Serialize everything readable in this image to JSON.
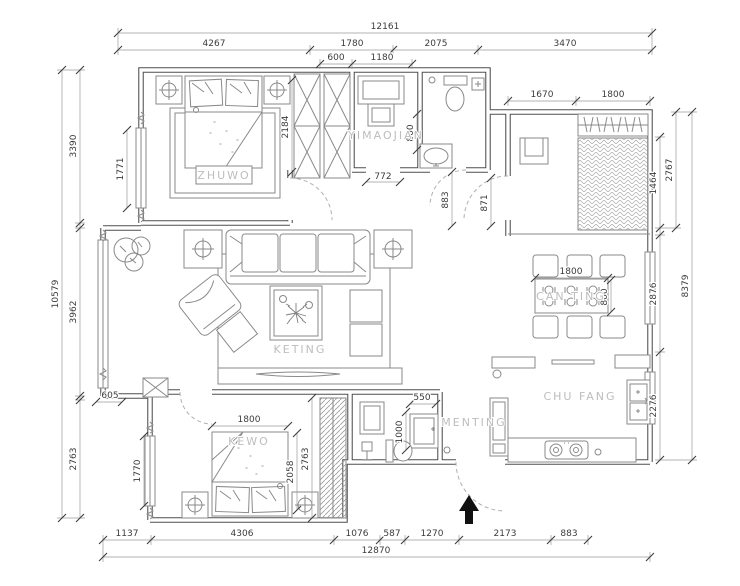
{
  "rooms": {
    "zhuwo": "ZHUWO",
    "yimaojian": "YIMAOJIAN",
    "keting": "KETING",
    "canting": "CAN TING",
    "chufang": "CHU FANG",
    "menting": "MENTING",
    "kewo": "KEWO"
  },
  "dims": {
    "top": {
      "overall": "12161",
      "segments": [
        "4267",
        "1780",
        "2075",
        "3470"
      ]
    },
    "bottom": {
      "overall": "12870",
      "segments": [
        "1137",
        "4306",
        "1076",
        "587",
        "1270",
        "2173",
        "883"
      ]
    },
    "left": {
      "overall": "10579",
      "segments": [
        "3390",
        "3962",
        "2763"
      ],
      "interior": [
        "1771",
        "605",
        "1770"
      ]
    },
    "right": {
      "outer": [
        "2767",
        "8379"
      ],
      "inner": [
        "1464",
        "2876",
        "2276"
      ]
    },
    "top_right": {
      "segments": [
        "1670",
        "1800"
      ]
    },
    "interior": {
      "closet_w1": "600",
      "closet_w2": "1180",
      "wardrobe_depth": "2184",
      "closet_opening": "772",
      "hall_door1": "883",
      "hall_door2": "871",
      "bath_w": "800",
      "dining_w": "1800",
      "dining_d": "800",
      "kewo_bed_w": "1800",
      "kewo_bed_l": "2058",
      "kewo_depth": "2763",
      "basin_w": "550",
      "basin_d": "1000"
    }
  },
  "colors": {
    "wall": "#4f4f4f",
    "dim_text": "#3b3b3b",
    "room_text": "#bdbdbd",
    "arrow": "#111111"
  }
}
